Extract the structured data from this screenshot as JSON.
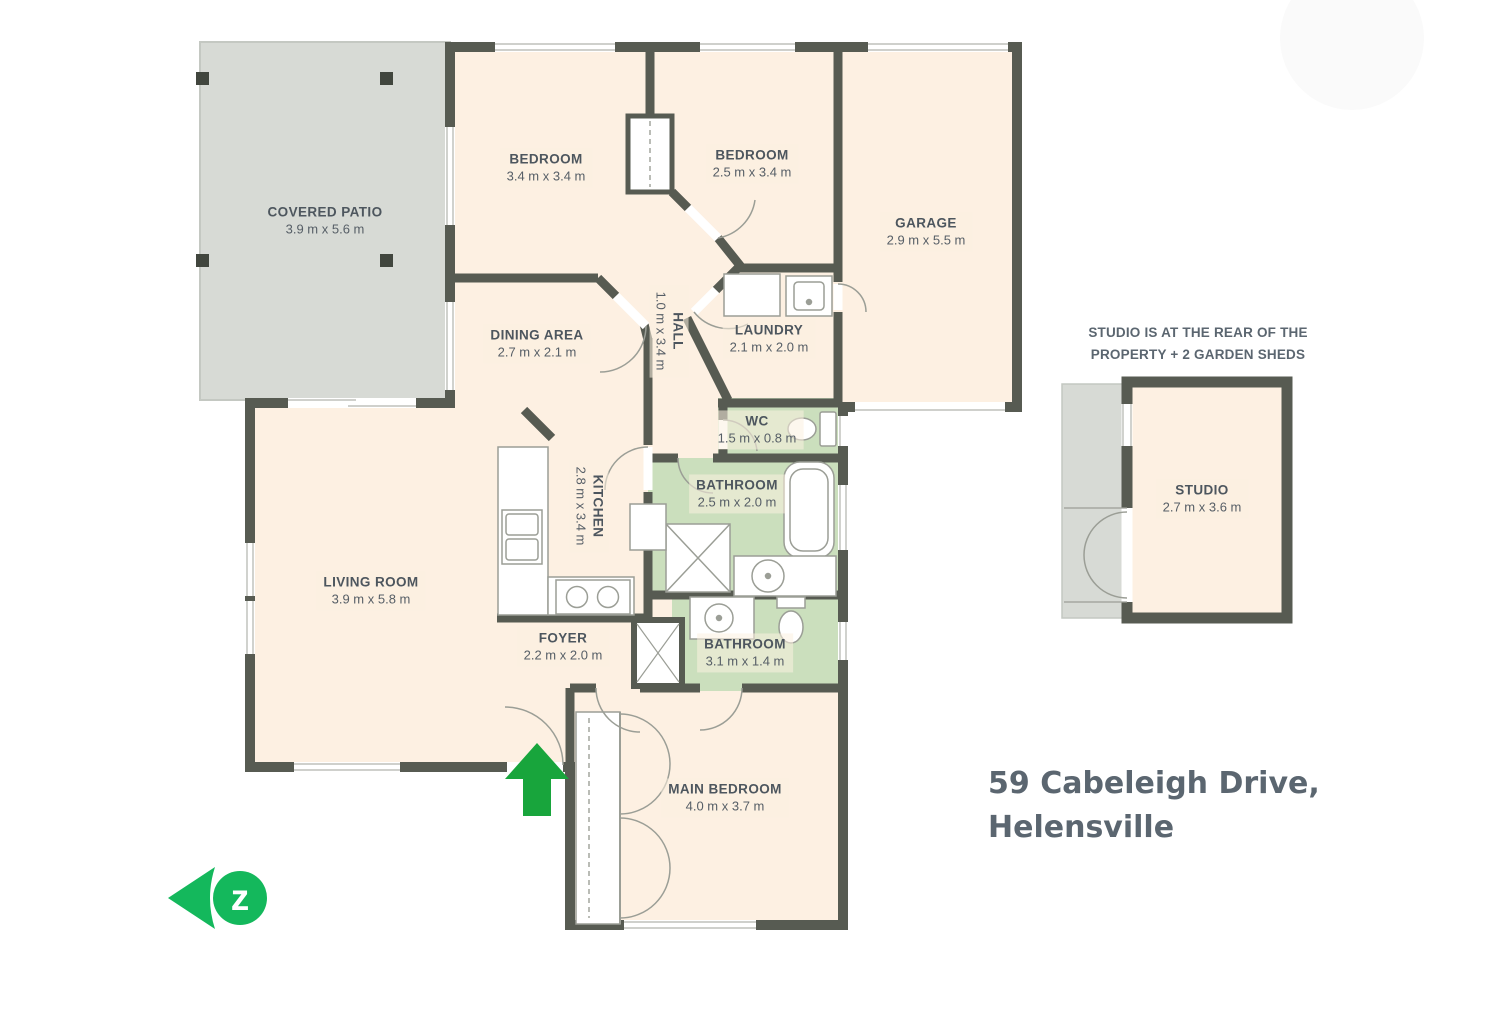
{
  "address": {
    "line1": "59 Cabeleigh Drive,",
    "line2": "Helensville"
  },
  "studio_note": "STUDIO IS AT THE REAR OF THE PROPERTY + 2 GARDEN SHEDS",
  "logo": {
    "letter": "z"
  },
  "colors": {
    "wall": "#575b52",
    "floor": "#fdf0e2",
    "wet_room_floor": "#cbdfbd",
    "patio": "#d7dad5",
    "entrance_arrow_green": "#18a53c",
    "logo_green": "#14b85c",
    "label_text": "#4d565e",
    "heading_text": "#5b6670"
  },
  "rooms": [
    {
      "name": "COVERED PATIO",
      "dims": "3.9 m x 5.6 m"
    },
    {
      "name": "BEDROOM",
      "dims": "3.4 m x 3.4 m"
    },
    {
      "name": "BEDROOM",
      "dims": "2.5 m x 3.4 m"
    },
    {
      "name": "GARAGE",
      "dims": "2.9 m x 5.5 m"
    },
    {
      "name": "DINING AREA",
      "dims": "2.7 m x 2.1 m"
    },
    {
      "name": "HALL",
      "dims": "1.0 m x 3.4 m"
    },
    {
      "name": "LAUNDRY",
      "dims": "2.1 m x 2.0 m"
    },
    {
      "name": "WC",
      "dims": "1.5 m x 0.8 m"
    },
    {
      "name": "BATHROOM",
      "dims": "2.5 m x 2.0 m"
    },
    {
      "name": "KITCHEN",
      "dims": "2.8 m x 3.4 m"
    },
    {
      "name": "LIVING ROOM",
      "dims": "3.9 m x 5.8 m"
    },
    {
      "name": "FOYER",
      "dims": "2.2 m x 2.0 m"
    },
    {
      "name": "BATHROOM",
      "dims": "3.1 m x 1.4 m"
    },
    {
      "name": "MAIN BEDROOM",
      "dims": "4.0 m x 3.7 m"
    },
    {
      "name": "STUDIO",
      "dims": "2.7 m x 3.6 m"
    }
  ]
}
